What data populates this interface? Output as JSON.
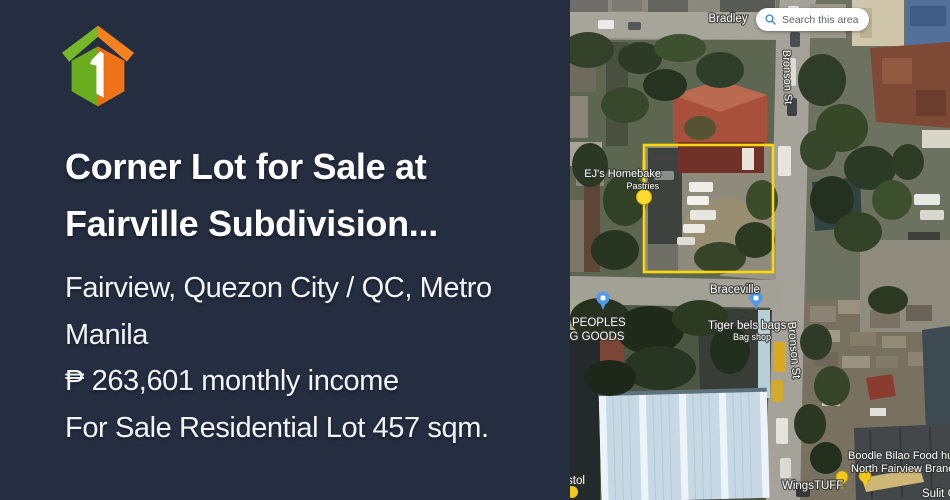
{
  "panel": {
    "title": {
      "line1": "Corner Lot for Sale at",
      "line2": "Fairville Subdivision..."
    },
    "location": {
      "line1": "Fairview, Quezon City / QC, Metro",
      "line2": "Manila"
    },
    "income": "₱ 263,601 monthly income",
    "sale_info": "For Sale Residential Lot 457 sqm.",
    "colors": {
      "background": "#252e41",
      "text": "#ffffff",
      "logo_green": "#76b82a",
      "logo_orange": "#f58220"
    }
  },
  "map": {
    "search_button": {
      "label": "Search this area"
    },
    "streets": {
      "bradley": "Bradley",
      "bronson_top": "Bronson St",
      "bronson_bottom": "Bronson St",
      "braceville": "Braceville"
    },
    "pois": {
      "ejs_homebake": {
        "line1": "EJ's Homebake",
        "line2": "Pastries"
      },
      "peoples_goods": {
        "line1": "PEOPLES",
        "line2": "ING GOODS"
      },
      "tiger_bels": {
        "line1": "Tiger bels bags",
        "line2": "Bag shop"
      },
      "boodle_bilao": {
        "line1": "Boodle Bilao Food hub",
        "line2": "North Fairview Branch"
      },
      "wingstuff": "WingsTUFF",
      "sulit": "Sulit G",
      "bristol": "stol"
    },
    "colors": {
      "lot_outline": "#f8d80c",
      "marker_yellow": "#ffd92e",
      "poi_pin_blue": "#4f9bea",
      "pin_yellow": "#f3c71c"
    }
  }
}
